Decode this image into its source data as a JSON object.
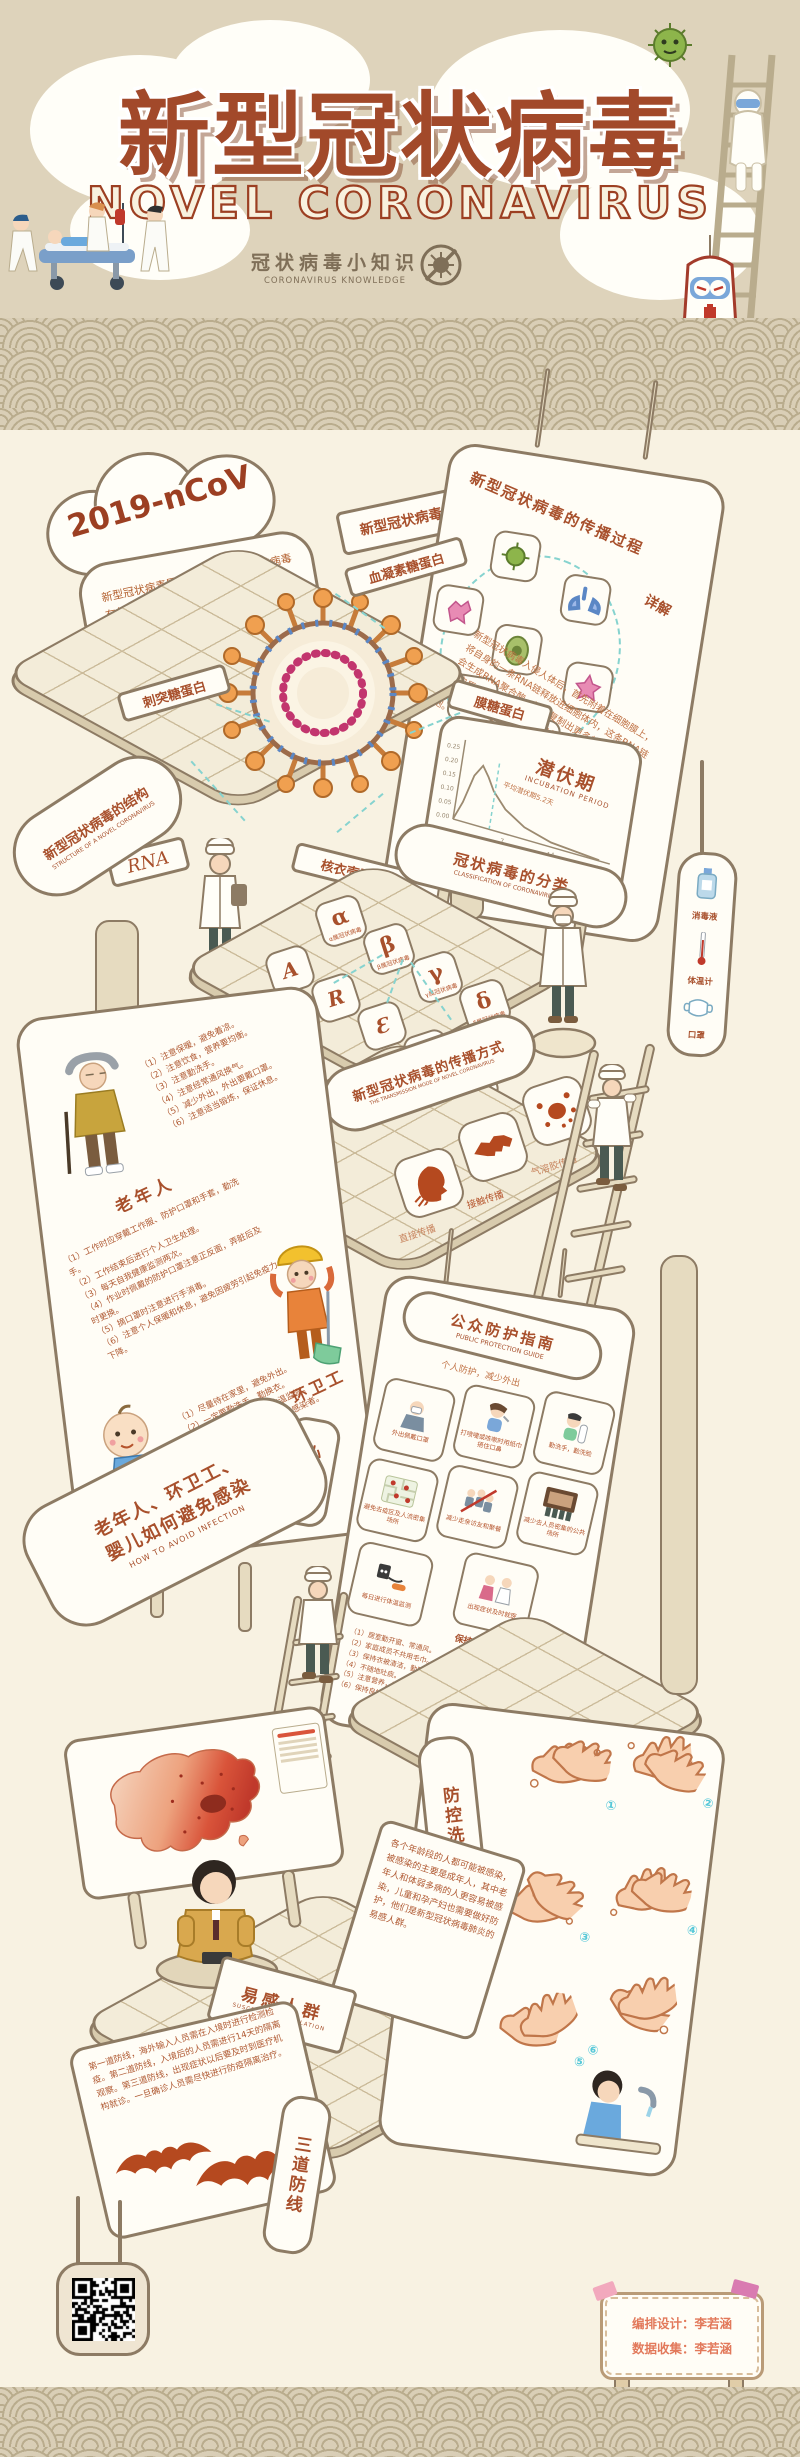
{
  "header": {
    "title_cn": "新型冠状病毒",
    "title_en": "NOVEL CORONAVIRUS",
    "subtitle_cn": "冠状病毒小知识",
    "subtitle_en": "CORONAVIRUS KNOWLEDGE"
  },
  "intro": {
    "cloud_label": "2019-nCoV",
    "text": "新型冠状病毒属于β属冠状病毒，其病毒有包膜，颗粒呈圆形或椭圆形，直径在60—140NM之间，因表面凸凹不平，形状似皇冠，因此称为冠状病毒。",
    "question_sign": "新型冠状病毒？"
  },
  "structure": {
    "sign_cn": "新型冠状病毒的结构",
    "sign_en": "STRUCTURE OF A NOVEL CORONAVIRUS",
    "label_hemagglutinin": "血凝素糖蛋白",
    "label_spike": "刺突糖蛋白",
    "label_rna": "RNA",
    "label_membrane": "膜糖蛋白",
    "label_nucleocapsid": "核衣壳蛋白"
  },
  "spread": {
    "title": "新型冠状病毒的传播过程",
    "detail_label": "详解",
    "text": "新型冠状病毒入侵人体后，首先附着在细胞膜上，将自身的一条RNA链释放进细胞体内，这条RNA链会生成RNA聚合酶，进而复制出更多的RNA片段和蛋白质，这些蛋白质和RNA片段不断组装生成新的病毒颗粒，最后释放出细胞，继续感染更多的细胞。"
  },
  "incubation": {
    "title_cn": "潜伏期",
    "title_en": "INCUBATION PERIOD"
  },
  "chart_data": {
    "type": "line",
    "title": "潜伏期 INCUBATION PERIOD",
    "xlabel": "从感染到发病的时间（天）",
    "ylabel": "",
    "x": [
      0,
      1,
      2,
      3,
      4,
      5,
      7,
      10,
      14,
      21
    ],
    "y": [
      0,
      0.08,
      0.2,
      0.25,
      0.21,
      0.16,
      0.1,
      0.05,
      0.02,
      0.005
    ],
    "xticks": [
      "7",
      "14",
      "21"
    ],
    "yticks": [
      "0.25",
      "0.20",
      "0.15",
      "0.10",
      "0.05",
      "0.00"
    ],
    "annotation": "平均潜伏期5.2天",
    "mean_days": 5.2,
    "xlim": [
      0,
      22
    ],
    "ylim": [
      0,
      0.3
    ],
    "grid": false,
    "legend": "none"
  },
  "classification": {
    "sign_cn": "冠状病毒的分类",
    "sign_en": "CLASSIFICATION OF CORONAVIRUSES",
    "genus": [
      {
        "letter": "α",
        "caption": "α属冠状病毒"
      },
      {
        "letter": "β",
        "caption": "β属冠状病毒"
      },
      {
        "letter": "γ",
        "caption": "γ属冠状病毒"
      },
      {
        "letter": "δ",
        "caption": "δ属冠状病毒"
      }
    ],
    "subtypes": [
      "A",
      "R",
      "Ɛ",
      "Ↄ",
      "D"
    ]
  },
  "transmission": {
    "sign_cn": "新型冠状病毒的传播方式",
    "sign_en": "THE TRANSMISSION MODE OF NOVEL CORONAVIRUS",
    "modes": [
      {
        "label": "直接传播"
      },
      {
        "label": "接触传播"
      },
      {
        "label": "气溶胶传播"
      }
    ]
  },
  "supplies": {
    "items": [
      {
        "label": "消毒液"
      },
      {
        "label": "体温计"
      },
      {
        "label": "口罩"
      }
    ]
  },
  "avoid": {
    "sign_cn_line1": "老年人、环卫工、",
    "sign_cn_line2": "婴儿如何避免感染",
    "sign_en": "HOW TO AVOID INFECTION",
    "tips_sign": "小贴士",
    "groups": [
      {
        "name": "老年人",
        "items": [
          "（1）注意保暖，避免着凉。",
          "（2）注意饮食，营养要均衡。",
          "（3）注意勤洗手。",
          "（4）注意经常通风换气。",
          "（5）减少外出，外出要戴口罩。",
          "（6）注意适当锻炼，保证休息。"
        ]
      },
      {
        "name": "环卫工",
        "items": [
          "（1）工作时应穿戴工作服、防护口罩和手套，勤洗手。",
          "（2）工作结束后进行个人卫生处理。",
          "（3）每天自我健康监测两次。",
          "（4）作业时佩戴的防护口罩注意正反面，弄脏后及时更换。",
          "（5）摘口罩时注意进行手消毒。",
          "（6）注意个人保暖和休息，避免因疲劳引起免疫力下降。"
        ]
      },
      {
        "name": "婴儿",
        "items": [
          "（1）尽量待在家里，避免外出。",
          "（2）一定要勤洗手、勤换衣。",
          "（3）一定要对婴儿进行体温监测。",
          "（4）一定要远离患者和可疑感染者。",
          "（5）外出一定要戴好口罩。",
          "（6）一定要吃熟食，少喝冷的饮料。"
        ]
      }
    ]
  },
  "guide": {
    "title_cn": "公众防护指南",
    "title_en": "PUBLIC PROTECTION GUIDE",
    "subtitle": "个人防护，减少外出",
    "tiles": [
      "外出佩戴口罩",
      "打喷嚏或咳嗽时用纸巾捂住口鼻",
      "勤洗手，勤洗脸",
      "避免去疫区及人流密集场所",
      "减少走亲访友和聚餐",
      "减少去人员密集的公共场所",
      "出现症状及时就医",
      "每日进行体温监测"
    ],
    "habits_title": "保持良好卫生和健康习惯",
    "habits": [
      "（1）居室勤开窗、常通风。",
      "（2）家庭成员不共用毛巾。",
      "（3）保持衣被清洁，勤晒衣被。",
      "（4）不随地吐痰。",
      "（5）注意营养，勤运动。",
      "（6）保持良好心态。"
    ]
  },
  "wash": {
    "sign": "防控洗手六步法",
    "steps": [
      "第一步 双手手心相互搓揉。",
      "第二步 双手手心交叉搓揉手指缝。",
      "第三步 手心对手背搓揉，左右手相同。",
      "第四步 指尖并拢在手心揉搓，左右手相同。",
      "第五步 一只手握住另一只手的拇指转动揉搓，左右手相同。",
      "第六步 一只手握住另一只手的手腕转动搓揉，左右手相同。"
    ],
    "numbers": [
      "①",
      "②",
      "③",
      "④",
      "⑤",
      "⑥"
    ]
  },
  "susceptible": {
    "sign_cn": "易感人群",
    "sign_en": "SUSCEPTIBLE POPULATION",
    "text": "各个年龄段的人都可能被感染，被感染的主要是成年人，其中老年人和体弱多病的人更容易被感染，儿童和孕产妇也需要做好防护，他们是新型冠状病毒肺炎的易感人群。"
  },
  "defense": {
    "sign": "三道防线",
    "text": "第一道防线，海外输入人员需在入境时进行检测检疫。第二道防线，入境后的人员需进行14天的隔离观察。第三道防线，出现症状以后要及时到医疗机构就诊。一旦确诊人员需尽快进行防疫隔离治疗。"
  },
  "credits": {
    "line1": "编排设计：李若涵",
    "line2": "数据收集：李若涵"
  },
  "colors": {
    "accent": "#a8502c",
    "border": "#8d7b64",
    "bg": "#f8f2e2",
    "header_bg": "#ded3bb",
    "dashed_line": "#86d3cf",
    "icon_red": "#b5491f"
  }
}
